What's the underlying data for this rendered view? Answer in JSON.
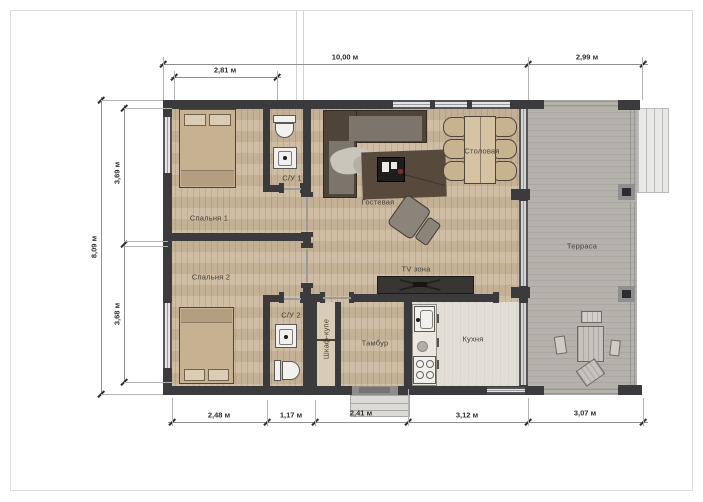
{
  "rooms": {
    "bedroom1": "Спальня 1",
    "bathroom1": "С/У 1",
    "bedroom2": "Спальня 2",
    "bathroom2": "С/У 2",
    "living": "Гостевая",
    "dining": "Столовая",
    "tv_zone": "TV зона",
    "wardrobe": "Шкаф-купе",
    "hall": "Тамбур",
    "kitchen": "Кухня",
    "terrace": "Терраса"
  },
  "dims": {
    "top_main": "10,00 м",
    "top_terrace": "2,99 м",
    "top_sub": "2,81 м",
    "left_total": "8,09 м",
    "left_upper": "3,69 м",
    "left_lower": "3,68 м",
    "bottom_1": "2,48 м",
    "bottom_2": "1,17 м",
    "bottom_3": "2,41 м",
    "bottom_4": "3,12 м",
    "bottom_5": "3,07 м"
  },
  "colors": {
    "wall": "#3b3a3c",
    "wood_floor": "#cbb89d",
    "terrace_floor": "#b5b1ab",
    "kitchen_floor": "#e2ded6",
    "sofa": "#4e4438",
    "dim_text": "#2d2d2d"
  }
}
